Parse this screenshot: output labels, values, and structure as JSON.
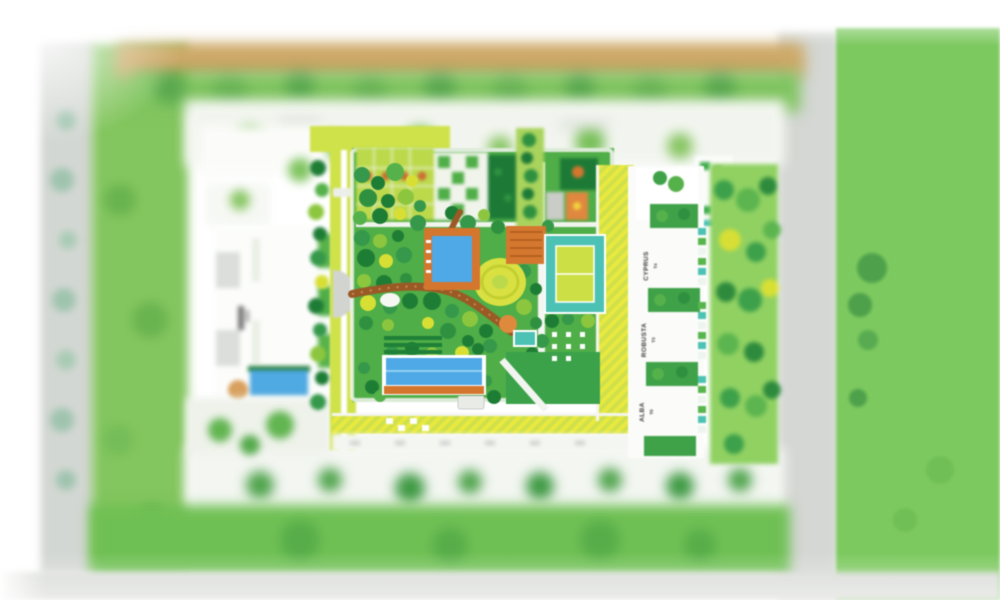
{
  "plan": {
    "title": "Residential masterplan site map (tilt-shift rendering)",
    "towers": [
      {
        "name": "CYPRUS",
        "unit": "T4"
      },
      {
        "name": "ROBUSTA",
        "unit": "T3"
      },
      {
        "name": "ALBA",
        "unit": "T0"
      }
    ],
    "features": [
      "upper-swimming-pool",
      "lap-pool",
      "splash-pool",
      "tennis-court",
      "linear-water-feature",
      "winding-garden-path",
      "central-garden",
      "hatched-yellow-road",
      "perimeter-roads",
      "tower-row",
      "left-residence-block"
    ],
    "colors": {
      "garden_green": "#4fae47",
      "field_green": "#7cc95f",
      "pool_blue": "#4fa9e6",
      "deck_orange": "#d4762e",
      "court_teal": "#4cc2b4",
      "court_inner_yellow": "#ccdf45",
      "path_brown": "#9a5a26",
      "hatch_yellow": "#e9e93f",
      "road_gray": "#d3d7d3",
      "sand_tan": "#cda968",
      "page_white": "#ffffff"
    }
  }
}
